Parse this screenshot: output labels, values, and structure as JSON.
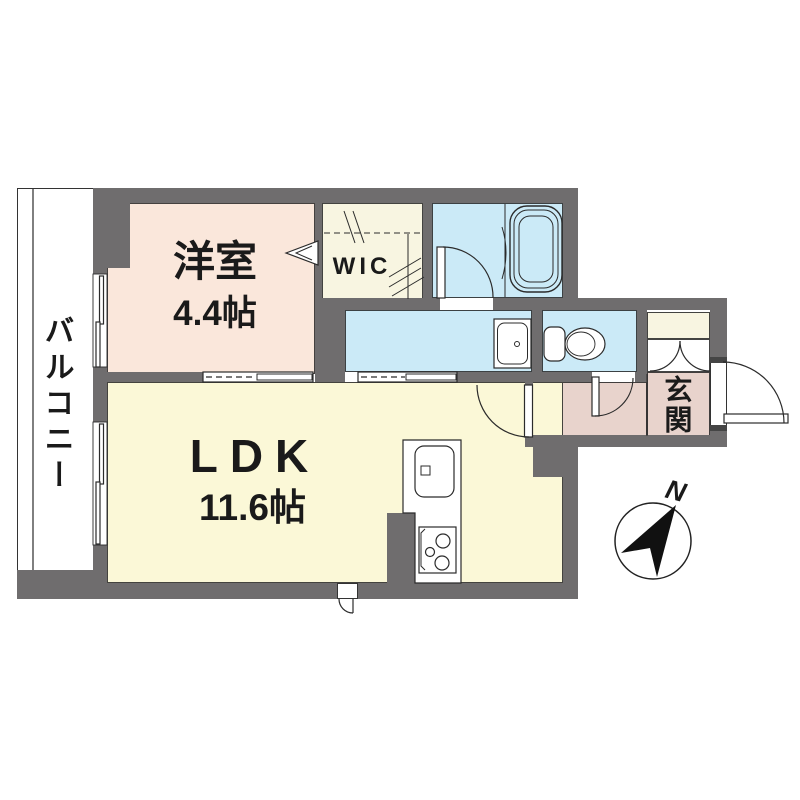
{
  "rooms": {
    "balcony": {
      "label": "バルコニー"
    },
    "yoshitsu": {
      "label": "洋室",
      "size": "4.4帖"
    },
    "wic": {
      "label": "WIC"
    },
    "ldk": {
      "label": "LDK",
      "size": "11.6帖"
    },
    "genkan": {
      "label": "玄関"
    }
  },
  "compass": {
    "north_label": "N"
  },
  "colors": {
    "wall": "#6f6d6e",
    "western_room_floor": "#fae7db",
    "ldk_floor": "#fbf8d7",
    "wet_area_floor": "#cbeaf7",
    "closet_floor": "#f8f5e1",
    "entrance_floor": "#e8d3cc",
    "line": "#2b2b2b"
  },
  "fixtures": [
    "bathtub",
    "washbasin",
    "toilet",
    "kitchen-sink",
    "gas-stove",
    "shoe-cabinet",
    "wic-hanger-rods",
    "sliding-windows",
    "sliding-doors",
    "hinged-doors",
    "north-compass"
  ]
}
